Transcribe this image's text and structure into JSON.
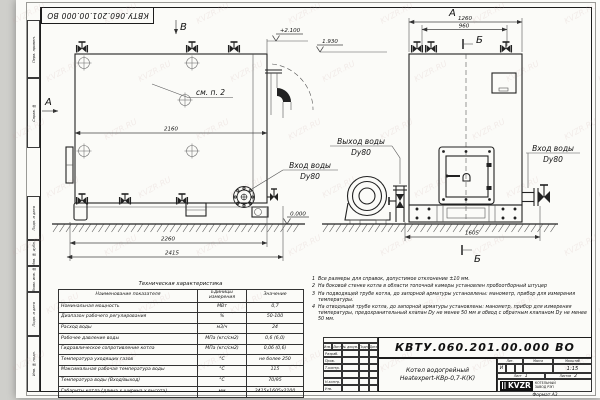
{
  "sheet": {
    "doc_number": "КВТУ.060.201.00.000 ВО",
    "format_label": "Формат А3",
    "watermark": "KVZR.RU",
    "frame_labels": [
      "Перв. примен.",
      "Справ. №",
      "Подп. и дата",
      "Инв. № дубл.",
      "Взам. инв. №",
      "Подп. и дата",
      "Инв. № подл."
    ]
  },
  "views": {
    "side": {
      "view_arrow_label": "А",
      "top_arrow_label": "В",
      "callout": "см. п. 2",
      "dim_inner_width": "2160",
      "dim_base_width": "2260",
      "dim_total_length": "2415",
      "elev_top": "+2.100",
      "elev_flue": "1.930",
      "elev_zero": "0.000",
      "inlet_line1": "Вход воды",
      "inlet_line2": "Dу80"
    },
    "front": {
      "view_title": "А",
      "section_label_top": "Б",
      "section_label_bottom": "Б",
      "dim_top_outer": "1260",
      "dim_top_inner": "960",
      "dim_width": "1605",
      "outlet_line1": "Выход воды",
      "outlet_line2": "Dу80",
      "inlet_line1": "Вход воды",
      "inlet_line2": "Dу80"
    }
  },
  "tech_table": {
    "title": "Техническая характеристика",
    "headers": {
      "name": "Наименование показателя",
      "unit": "Единицы измерения",
      "value": "Значение"
    },
    "rows": [
      {
        "name": "Номинальная мощность",
        "unit": "МВт",
        "value": "0,7"
      },
      {
        "name": "Диапазон рабочего регулирования",
        "unit": "%",
        "value": "50-100"
      },
      {
        "name": "Расход воды",
        "unit": "м3/ч",
        "value": "24"
      },
      {
        "name": "Рабочее давление воды",
        "unit": "МПа (кгс/см2)",
        "value": "0,6 (6,0)"
      },
      {
        "name": "Гидравлическое сопротивление котла",
        "unit": "МПа (кгс/см2)",
        "value": "0,06 (0,6)"
      },
      {
        "name": "Температура уходящих газов",
        "unit": "°С",
        "value": "не более 250"
      },
      {
        "name": "Максимальная рабочая температура воды",
        "unit": "°С",
        "value": "115"
      },
      {
        "name": "Температура воды (Вход/выход)",
        "unit": "°С",
        "value": "70/95"
      },
      {
        "name": "Габариты котла (длина х ширина х высота)",
        "unit": "мм",
        "value": "2415х1605х2100"
      }
    ]
  },
  "notes": {
    "items": [
      {
        "num": "1",
        "text": "Все размеры для справок, допустимое отклонение ±10 мм."
      },
      {
        "num": "2",
        "text": "На боковой стенке котла в области топочной камеры установлен пробоотборный штуцер"
      },
      {
        "num": "3",
        "text": "На подводящей трубе котла, до запорной арматуры установлены: манометр, прибор для измерения температуры."
      },
      {
        "num": "4",
        "text": "На отводящей трубе котла, до запорной арматуры установлены: манометр, прибор для измерения температуры, предохранительный клапан Dу не менее 50 мм и обвод с обратным клапаном Dу не менее 50 мм."
      }
    ]
  },
  "title_block": {
    "doc_number": "КВТУ.060.201.00.000 ВО",
    "product_line1": "Котел водогрейный",
    "product_line2": "Heatexpert-КВр-0,7-К(К)",
    "header_cols": [
      "Изм.",
      "Лист",
      "№ докум.",
      "Подп.",
      "Дата"
    ],
    "rows": [
      "Разраб.",
      "Пров.",
      "Т.контр.",
      "",
      "Н.контр.",
      "Утв."
    ],
    "lit_label": "Лит.",
    "lit_value": "И",
    "mass_label": "Масса",
    "scale_label": "Масштаб",
    "scale_value": "1:15",
    "sheet_label": "Лист",
    "sheet_value": "1",
    "sheets_label": "Листов",
    "sheets_value": "2",
    "company_logo": "KVZR",
    "company_name": "КОТЕЛЬНЫЙ ЗАВОД РЭП"
  }
}
